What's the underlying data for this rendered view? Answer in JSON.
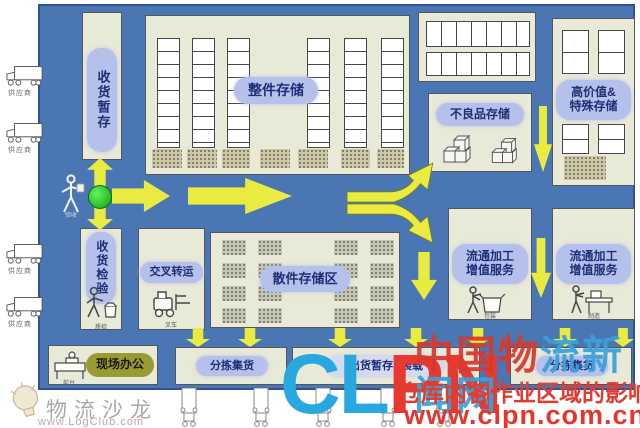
{
  "diagram": {
    "zones": {
      "receiving_staging": "收货暂存",
      "full_case_storage": "整件存储",
      "high_value_line1": "高价值&",
      "high_value_line2": "特殊存储",
      "defective_storage": "不良品存储",
      "receiving_inspection": "收货检验",
      "cross_dock": "交叉转运",
      "loose_storage": "散件存储区",
      "value_add_line1": "流通加工",
      "value_add_line2": "增值服务",
      "office": "现场办公",
      "sort_consolidate": "分拣集货",
      "outbound_staging": "出货暂存&装载"
    },
    "captions": {
      "supplier": "供应商",
      "checker": "验收",
      "inspector": "质检",
      "forklift": "叉车",
      "desk": "前台",
      "packing": "包装",
      "assembly": "制造"
    },
    "colors": {
      "field_blue": "#4b76b4",
      "panel_cream": "#e9e9d8",
      "label_blue": "#b5c1ea",
      "arrow_yellow": "#e9eb40",
      "entry_green": "#0da10d"
    }
  },
  "watermarks": {
    "logo_name": "物流沙龙",
    "logo_url": "www.LogClub.com",
    "clpn_blue": "CL",
    "clpn_red": "PN",
    "site_name_red": "中国物",
    "site_name_blue": "流新闻网",
    "article_title": "仓库内各作业区域的影响",
    "site_url": "www.clpn.com.cn"
  }
}
